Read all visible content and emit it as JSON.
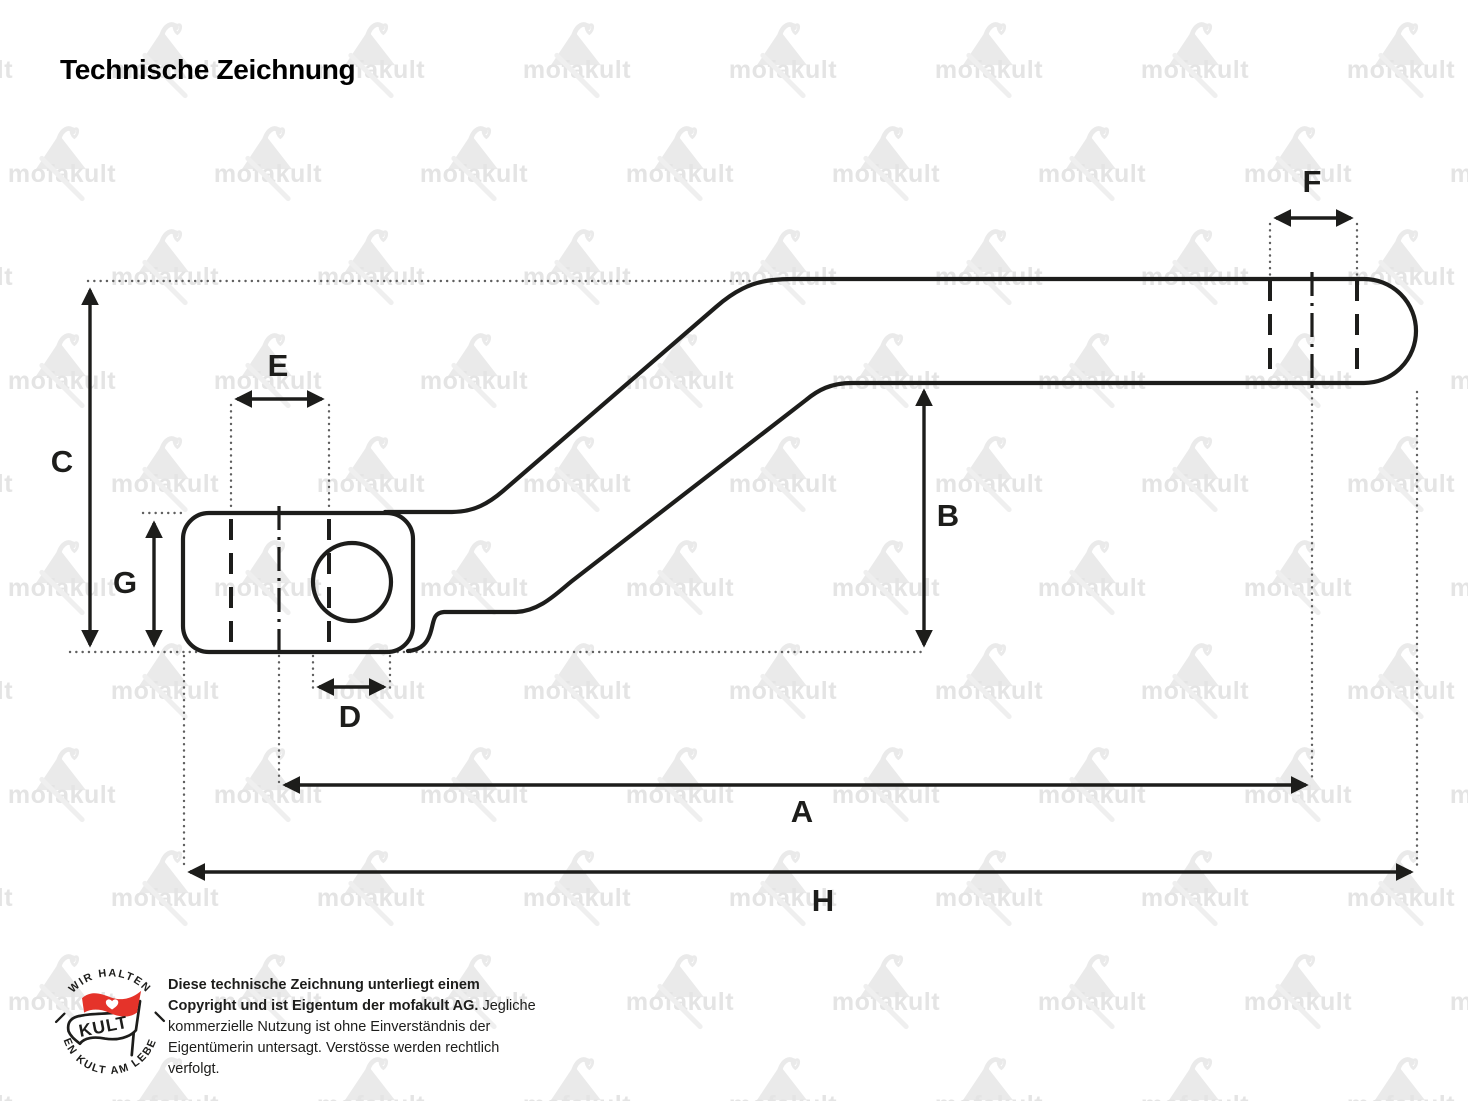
{
  "title": "Technische Zeichnung",
  "watermark": {
    "text": "mofakult",
    "icon": "mofakult-swan-icon",
    "text_color": "#e4e4e4",
    "icon_color": "#eaeaea"
  },
  "drawing": {
    "type": "technical-drawing-kickstart-lever",
    "line_color": "#1d1d1b",
    "extension_line_color": "#5f5f5f",
    "dimensions": [
      {
        "label": "A"
      },
      {
        "label": "B"
      },
      {
        "label": "C"
      },
      {
        "label": "D"
      },
      {
        "label": "E"
      },
      {
        "label": "F"
      },
      {
        "label": "G"
      },
      {
        "label": "H"
      }
    ]
  },
  "footer": {
    "badge": {
      "arc_top": "WIR HALTEN",
      "arc_bottom": "DEN KULT AM LEBEN",
      "flag_label": "KULT",
      "flag_color": "#e5332a",
      "heart_icon": "heart-icon"
    },
    "copyright": {
      "bold": "Diese technische Zeichnung unterliegt einem Copyright und ist Eigentum der mofakult AG.",
      "regular": "Jegliche kommerzielle Nutzung ist ohne Einverständnis der Eigentümerin untersagt. Verstösse werden rechtlich verfolgt."
    }
  }
}
